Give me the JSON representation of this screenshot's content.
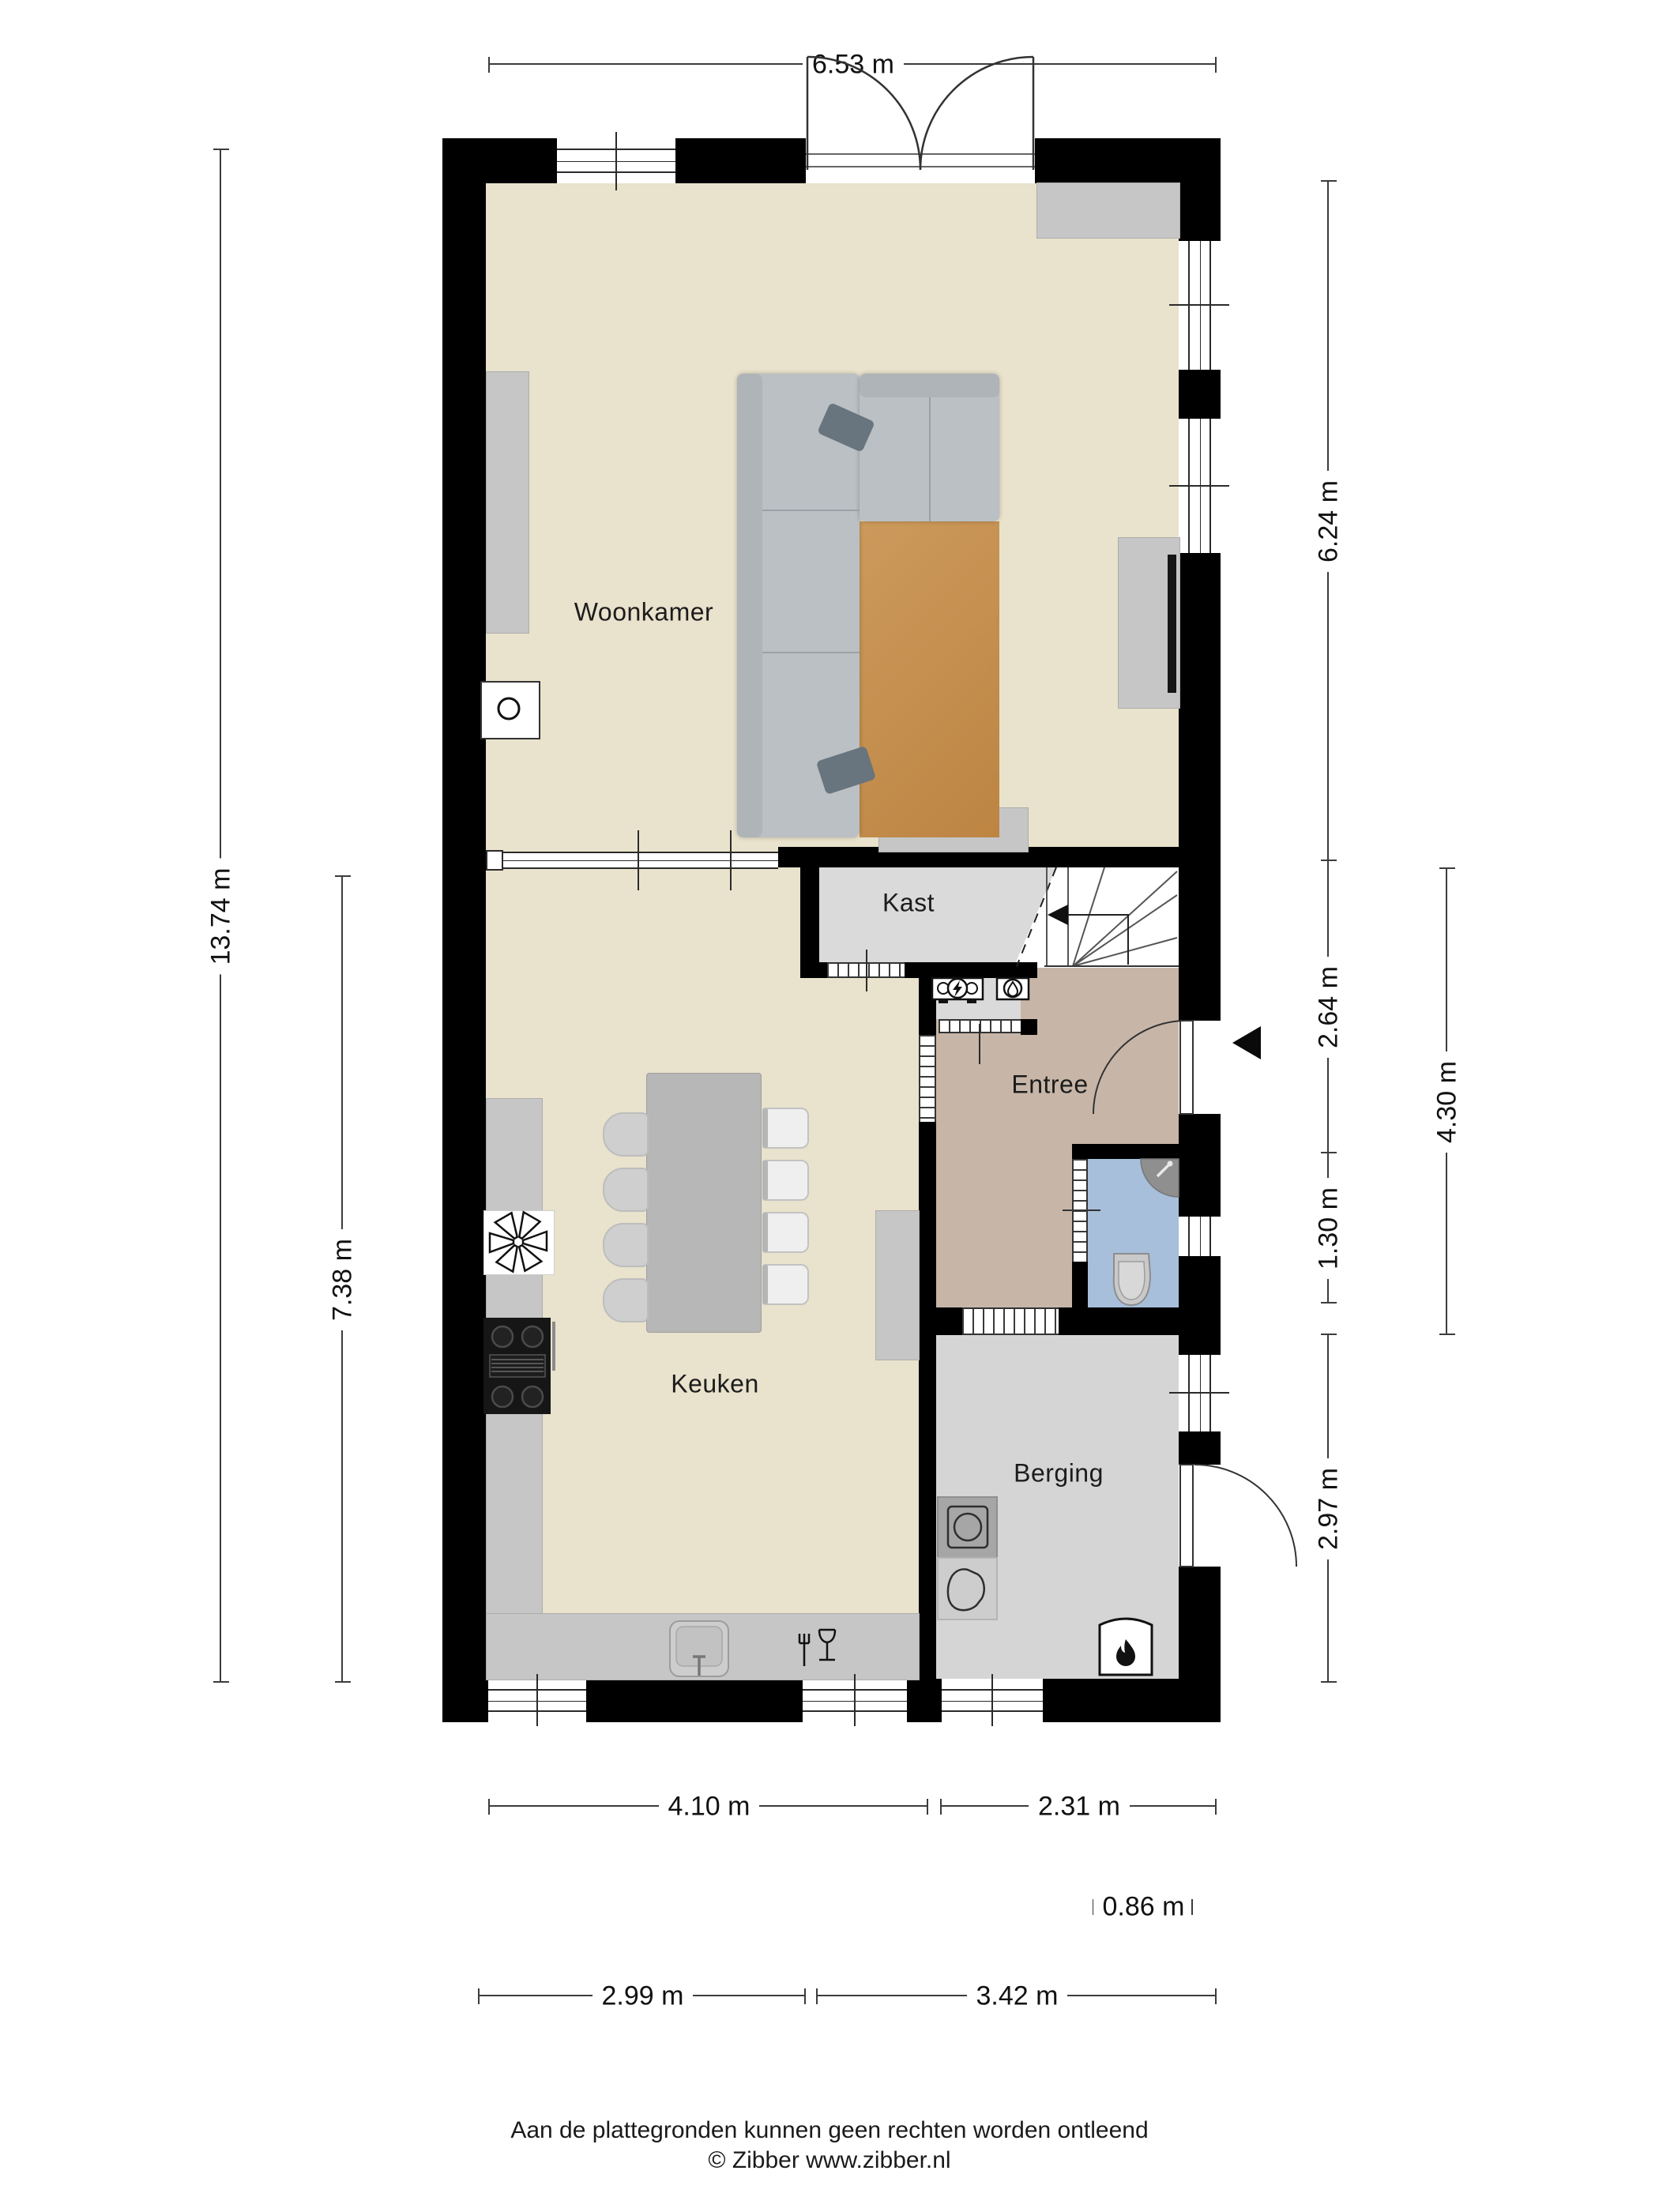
{
  "title": "Begane grond plattegrond",
  "rooms": {
    "woonkamer": "Woonkamer",
    "kast": "Kast",
    "entree": "Entree",
    "keuken": "Keuken",
    "berging": "Berging"
  },
  "dimensions": {
    "top_width": "6.53 m",
    "left_total_height": "13.74 m",
    "left_kitchen_height": "7.38 m",
    "right_segments": [
      "6.24 m",
      "2.64 m",
      "1.30 m",
      "2.97 m"
    ],
    "right_inner": "4.30 m",
    "bottom_row1": [
      "4.10 m",
      "2.31 m"
    ],
    "bottom_door": "0.86 m",
    "bottom_row2": [
      "2.99 m",
      "3.42 m"
    ]
  },
  "footer": {
    "line1": "Aan de plattegronden kunnen geen rechten worden ontleend",
    "line2": "© Zibber www.zibber.nl"
  },
  "icons": {
    "ventilation": "fan-asterisk",
    "electric_meter": "circle-lightning",
    "water_meter": "circle-drop",
    "boiler": "flame",
    "washing_machine": "square-circle",
    "dryer": "container-outline",
    "dishwasher": "fork-and-glass",
    "entrance_arrow": "triangle-left",
    "stairs_direction": "arrow-left"
  },
  "colors": {
    "wall": "#000000",
    "floor_living": "#e9e2cc",
    "floor_entree": "#c7b6a8",
    "floor_kast": "#dadada",
    "floor_berging": "#d5d5d5",
    "floor_toilet": "#a8bfdb",
    "rug": "#c79252",
    "sofa": "#bac0c3",
    "furniture": "#c6c6c6",
    "dimension_lines": "#3c3c3c"
  }
}
